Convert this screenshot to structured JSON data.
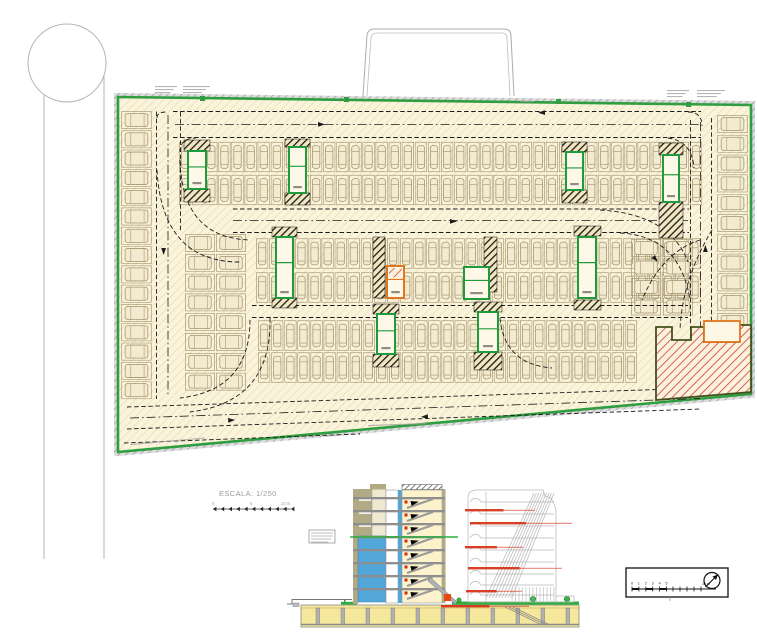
{
  "document": {
    "kind": "architectural CAD sheet",
    "views": {
      "plan": "underground parking level floor plan",
      "section": "building cross-section with facade elevation"
    }
  },
  "colors": {
    "boundary_green": "#2f9e41",
    "floor_cream": "#fbf4dd",
    "hatch_tan": "#e9d8a6",
    "border_gray": "#b9b9b9",
    "stall_line": "#a2946e",
    "stall_fill": "#f3ead0",
    "lane_black": "#1b1b1b",
    "hazard_black": "#191919",
    "hazard_cream": "#f2e6c0",
    "core_green": "#1e9c3b",
    "core_orange": "#e0761f",
    "ramp_red": "#c63d2a",
    "ramp_border": "#42521d",
    "road_gray": "#b5b5b5",
    "section_tan": "#b2aa85",
    "section_blue": "#52a6d8",
    "section_slab": "#8e8e8e",
    "section_stair_fill": "#fcf2cc",
    "basement_yellow": "#f5e79c",
    "ground_green": "#2fae3f",
    "annotation_red": "#d42b10",
    "elevation_gray": "#b6b6b6",
    "text_gray": "#9c9c9c",
    "ink": "#222222"
  },
  "plan": {
    "parking_rows": [
      {
        "t": "v",
        "x": 179,
        "y": 141,
        "n": 40,
        "s": 13.1,
        "w": 12.3,
        "h": 32
      },
      {
        "t": "v",
        "x": 179,
        "y": 174,
        "n": 40,
        "s": 13.1,
        "w": 12.3,
        "h": 32
      },
      {
        "t": "v",
        "x": 256,
        "y": 237,
        "n": 34,
        "s": 13.1,
        "w": 12.3,
        "h": 33
      },
      {
        "t": "v",
        "x": 256,
        "y": 271,
        "n": 34,
        "s": 13.1,
        "w": 12.3,
        "h": 33
      },
      {
        "t": "v",
        "x": 258,
        "y": 320,
        "n": 29,
        "s": 13.1,
        "w": 12.3,
        "h": 31
      },
      {
        "t": "v",
        "x": 258,
        "y": 352,
        "n": 29,
        "s": 13.1,
        "w": 12.3,
        "h": 31
      },
      {
        "t": "h",
        "x": 121,
        "y": 111,
        "n": 15,
        "s": 19.3,
        "w": 31,
        "h": 18
      },
      {
        "t": "h",
        "x": 716,
        "y": 115,
        "n": 14,
        "s": 19.8,
        "w": 33,
        "h": 18
      },
      {
        "t": "h",
        "x": 185,
        "y": 234,
        "n": 8,
        "s": 19.8,
        "w": 30,
        "h": 18
      },
      {
        "t": "h",
        "x": 216,
        "y": 234,
        "n": 8,
        "s": 19.8,
        "w": 30,
        "h": 18
      },
      {
        "t": "h",
        "x": 631,
        "y": 239,
        "n": 4,
        "s": 19.5,
        "w": 30,
        "h": 18
      },
      {
        "t": "h",
        "x": 663,
        "y": 239,
        "n": 4,
        "s": 19.5,
        "w": 30,
        "h": 18
      }
    ],
    "hazard_strips": [
      {
        "x": 184,
        "y": 140,
        "w": 26,
        "h": 11
      },
      {
        "x": 184,
        "y": 189,
        "w": 26,
        "h": 13
      },
      {
        "x": 285,
        "y": 139,
        "w": 25,
        "h": 8
      },
      {
        "x": 285,
        "y": 193,
        "w": 25,
        "h": 12
      },
      {
        "x": 562,
        "y": 142,
        "w": 25,
        "h": 10
      },
      {
        "x": 562,
        "y": 190,
        "w": 25,
        "h": 13
      },
      {
        "x": 659,
        "y": 143,
        "w": 24,
        "h": 12
      },
      {
        "x": 659,
        "y": 202,
        "w": 24,
        "h": 36
      },
      {
        "x": 272,
        "y": 227,
        "w": 25,
        "h": 10
      },
      {
        "x": 272,
        "y": 298,
        "w": 25,
        "h": 10
      },
      {
        "x": 574,
        "y": 226,
        "w": 27,
        "h": 10
      },
      {
        "x": 574,
        "y": 300,
        "w": 27,
        "h": 10
      },
      {
        "x": 373,
        "y": 237,
        "w": 12,
        "h": 61
      },
      {
        "x": 484,
        "y": 237,
        "w": 13,
        "h": 55
      },
      {
        "x": 373,
        "y": 304,
        "w": 26,
        "h": 10
      },
      {
        "x": 373,
        "y": 354,
        "w": 26,
        "h": 13
      },
      {
        "x": 474,
        "y": 302,
        "w": 28,
        "h": 10
      },
      {
        "x": 474,
        "y": 352,
        "w": 28,
        "h": 18
      }
    ],
    "cores": [
      {
        "x": 188,
        "y": 151,
        "w": 18,
        "h": 38,
        "c": "green"
      },
      {
        "x": 289,
        "y": 147,
        "w": 17,
        "h": 46,
        "c": "green"
      },
      {
        "x": 566,
        "y": 152,
        "w": 17,
        "h": 38,
        "c": "green"
      },
      {
        "x": 663,
        "y": 155,
        "w": 16,
        "h": 47,
        "c": "green"
      },
      {
        "x": 276,
        "y": 237,
        "w": 17,
        "h": 61,
        "c": "green"
      },
      {
        "x": 578,
        "y": 237,
        "w": 18,
        "h": 61,
        "c": "green"
      },
      {
        "x": 387,
        "y": 266,
        "w": 17,
        "h": 32,
        "c": "orange"
      },
      {
        "x": 464,
        "y": 267,
        "w": 25,
        "h": 32,
        "c": "room"
      },
      {
        "x": 377,
        "y": 314,
        "w": 18,
        "h": 40,
        "c": "green"
      },
      {
        "x": 478,
        "y": 312,
        "w": 20,
        "h": 40,
        "c": "green"
      }
    ],
    "border_markers": [
      {
        "x": 344,
        "y": 97
      },
      {
        "x": 556,
        "y": 99
      },
      {
        "x": 686,
        "y": 102
      },
      {
        "x": 200,
        "y": 96
      }
    ],
    "micro_annotations": [
      {
        "x": 155,
        "y": 86,
        "w": 22,
        "n": 3,
        "r": 0
      },
      {
        "x": 183,
        "y": 86,
        "w": 27,
        "n": 3,
        "r": 0
      },
      {
        "x": 667,
        "y": 90,
        "w": 22,
        "n": 3,
        "r": 0
      },
      {
        "x": 697,
        "y": 90,
        "w": 28,
        "n": 3,
        "r": 0
      },
      {
        "x": 130,
        "y": 444,
        "w": 75,
        "n": 1,
        "r": -5
      },
      {
        "x": 368,
        "y": 425,
        "w": 58,
        "n": 1,
        "r": -2
      },
      {
        "x": 520,
        "y": 101,
        "w": 14,
        "n": 1,
        "r": 0
      }
    ],
    "ramp_note": "hatched exclusion / ramp zone at south-east corner"
  },
  "scale_bar": {
    "label": "ESCALA: 1/250",
    "tick_labels": [
      "0",
      "5",
      "10 m"
    ],
    "x0": 213,
    "x1": 291,
    "y": 509,
    "ticks": 11
  },
  "north_scale_box": {
    "numbers": [
      "0",
      "1",
      "2",
      "3",
      "4",
      "5"
    ],
    "end_label": "10 m",
    "icon": "north-arrow"
  },
  "section": {
    "floor_ys": [
      497,
      510,
      523,
      536,
      549,
      562,
      575,
      588
    ],
    "elevation_floor_ys": [
      502,
      514,
      526,
      538,
      550,
      562,
      574,
      585,
      595
    ],
    "basement_columns": [
      316,
      341,
      366,
      391,
      416,
      441,
      466,
      491,
      516,
      541,
      566
    ],
    "red_annotations": [
      {
        "x": 465,
        "y": 509,
        "w": 70
      },
      {
        "x": 470,
        "y": 522,
        "w": 102
      },
      {
        "x": 465,
        "y": 546,
        "w": 58
      },
      {
        "x": 468,
        "y": 567,
        "w": 94
      },
      {
        "x": 466,
        "y": 590,
        "w": 56
      },
      {
        "x": 441,
        "y": 605,
        "w": 88
      }
    ],
    "stair_arrow_count": 8
  }
}
